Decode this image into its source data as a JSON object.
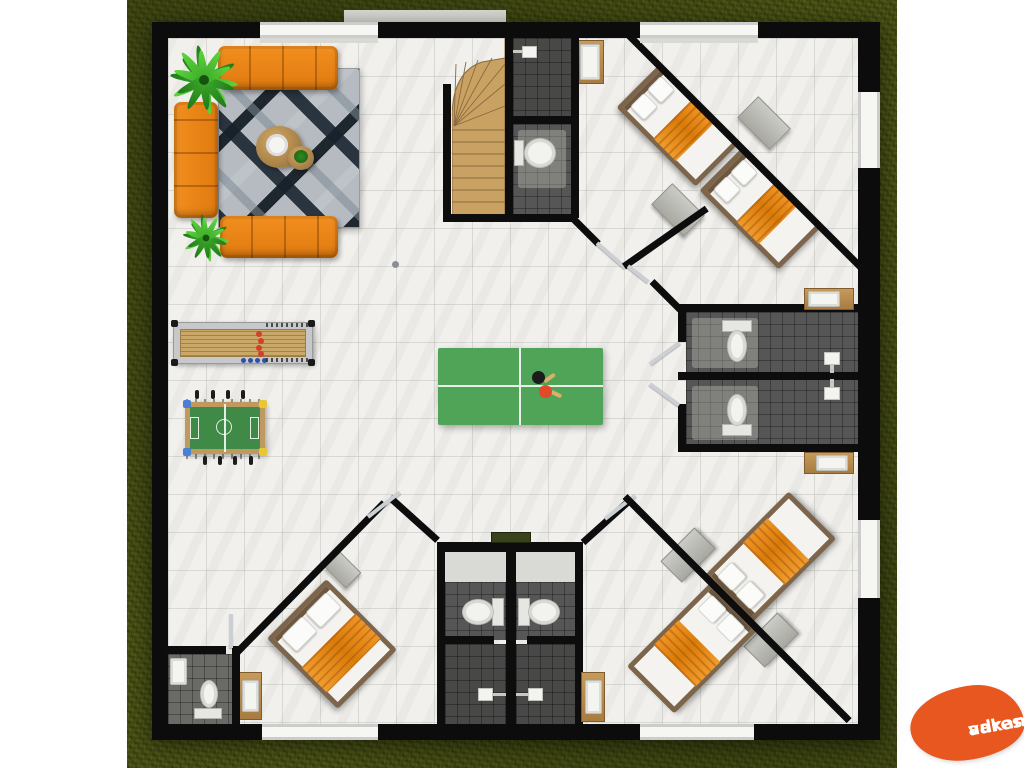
{
  "brand": {
    "line1": "vakantie",
    "line2": "adressen",
    "background": "#e8571f",
    "text_color": "#ffffff"
  },
  "palette": {
    "grass": "#4a5214",
    "wall": "#0d0d0d",
    "floor_marble": "#f1f0ed",
    "bath_tile": "#565656",
    "stair_wood": "#c9a263",
    "sofa_orange": "#ee8317",
    "bed_blanket_orange": "#e3820f",
    "rug_base": "#b6bbc1",
    "rug_dark_navy": "#16212c",
    "ping_pong_green": "#4fa458",
    "foosball_green": "#3f8a46",
    "shuffleboard_lane": "#c9a86a",
    "puck_red": "#d0402a",
    "puck_blue": "#2b52a8",
    "door_leaf": "#ccd0d4",
    "cabinet_wood": "#b98a4e"
  },
  "icons": {
    "toilet": "css-shape",
    "shower-head": "css-shape",
    "sink": "css-shape",
    "staircase": "inline-svg",
    "plant": "inline-svg",
    "bed": "css-shape",
    "sofa": "css-shape",
    "ping-pong-paddles": "css-shape",
    "brand-logo": "css-blob"
  }
}
